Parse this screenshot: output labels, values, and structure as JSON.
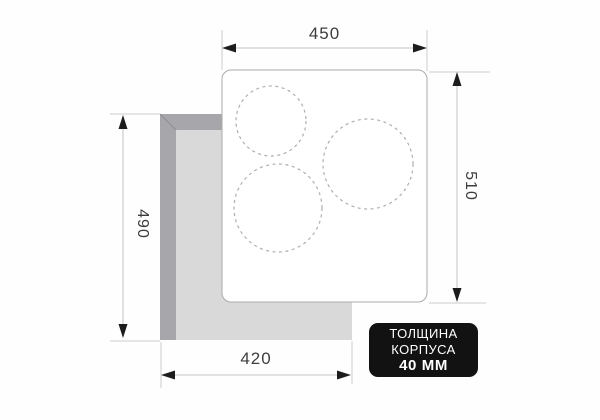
{
  "dimensions": {
    "top_width": "450",
    "right_height": "510",
    "left_height": "490",
    "bottom_width": "420"
  },
  "badge": {
    "line1": "ТОЛЩИНА",
    "line2": "КОРПУСА",
    "line3": "40 ММ"
  },
  "burner_zones": 3,
  "colors": {
    "badge_bg": "#121212",
    "badge_text": "#ffffff",
    "cutout_side": "#a7a7ab",
    "cutout_base": "#d9d9d9",
    "bevel_line": "#8f8f93",
    "panel_fill": "#ffffff",
    "panel_border": "#ababab",
    "dim_line": "#c4c4c4",
    "arrow": "#1c1c1c",
    "label_text": "#3d3d3d",
    "burner_dash": "#aeaeae"
  }
}
